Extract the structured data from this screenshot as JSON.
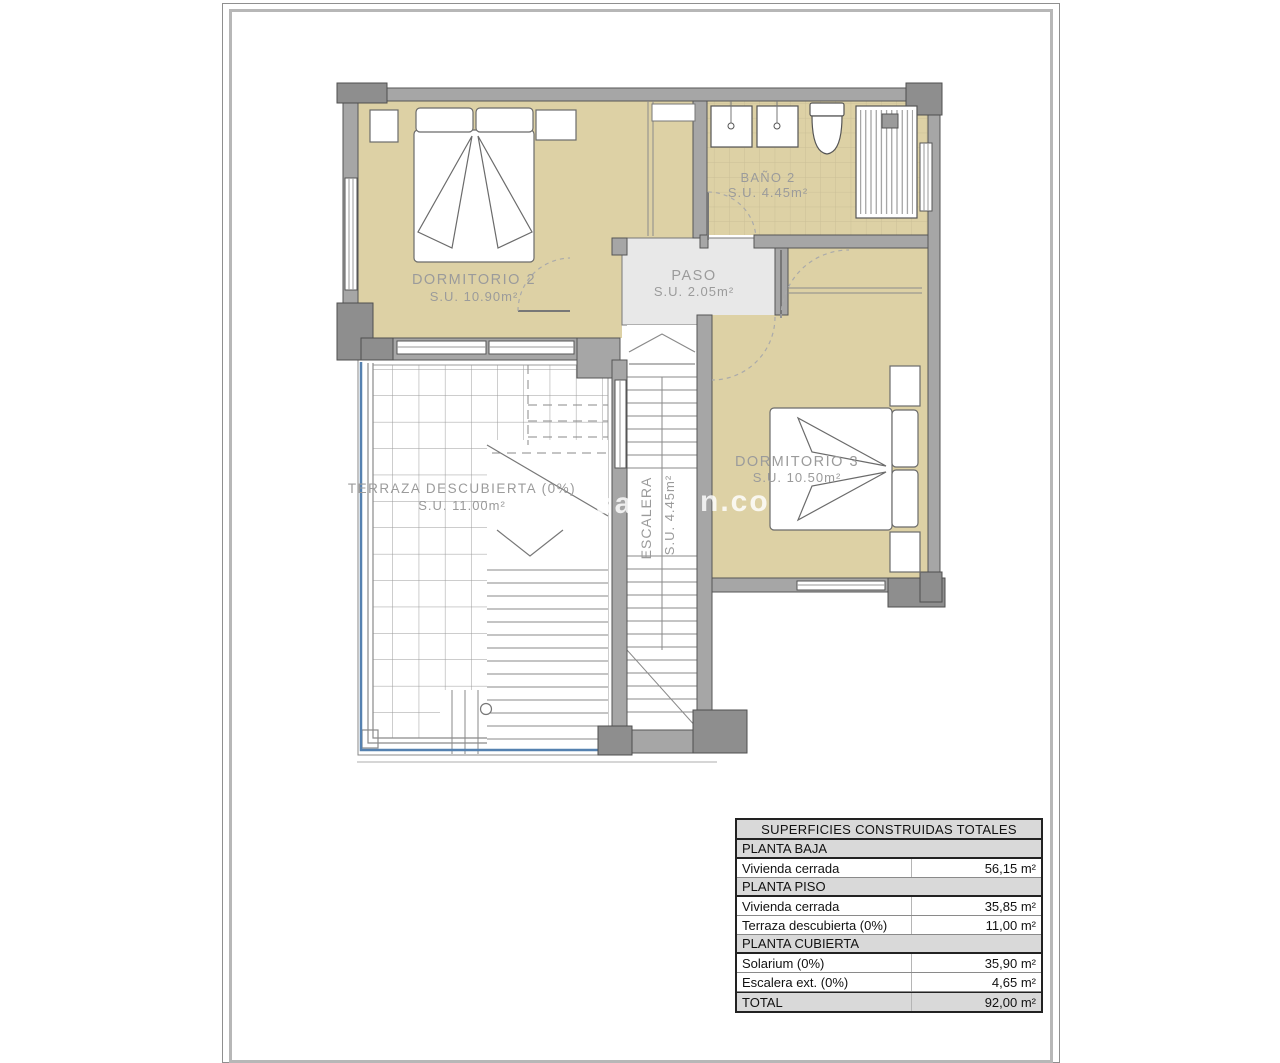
{
  "plan": {
    "rooms": {
      "dormitorio2": {
        "name": "DORMITORIO 2",
        "area": "S.U. 10.90m²"
      },
      "bano2": {
        "name": "BAÑO 2",
        "area": "S.U. 4.45m²"
      },
      "paso": {
        "name": "PASO",
        "area": "S.U. 2.05m²"
      },
      "dormitorio3": {
        "name": "DORMITORIO 3",
        "area": "S.U. 10.50m²"
      },
      "terraza": {
        "name": "TERRAZA DESCUBIERTA (0%)",
        "area": "S.U. 11.00m²"
      },
      "escalera": {
        "name": "ESCALERA",
        "area": "S.U. 4.45m²"
      }
    },
    "colors": {
      "wall": "#a6a6a6",
      "wall_dark": "#8e8e8e",
      "floor_tan": "#ddd1a5",
      "paso_floor": "#e8e8e8",
      "tile_line": "#cabf97",
      "outline": "#555555",
      "label": "#9b9b9b",
      "railing_blue": "#5581b0"
    }
  },
  "watermark": {
    "fragment_left": "sa",
    "fragment_right": "n.com"
  },
  "table": {
    "title": "SUPERFICIES CONSTRUIDAS TOTALES",
    "rows": [
      {
        "label": "PLANTA BAJA",
        "value": ""
      },
      {
        "label": "Vivienda cerrada",
        "value": "56,15 m²"
      },
      {
        "label": "PLANTA PISO",
        "value": ""
      },
      {
        "label": "Vivienda cerrada",
        "value": "35,85 m²"
      },
      {
        "label": "Terraza descubierta (0%)",
        "value": "11,00 m²"
      },
      {
        "label": "PLANTA CUBIERTA",
        "value": ""
      },
      {
        "label": "Solarium (0%)",
        "value": "35,90 m²"
      },
      {
        "label": "Escalera ext. (0%)",
        "value": "4,65 m²"
      },
      {
        "label": "TOTAL",
        "value": "92,00 m²"
      }
    ]
  }
}
